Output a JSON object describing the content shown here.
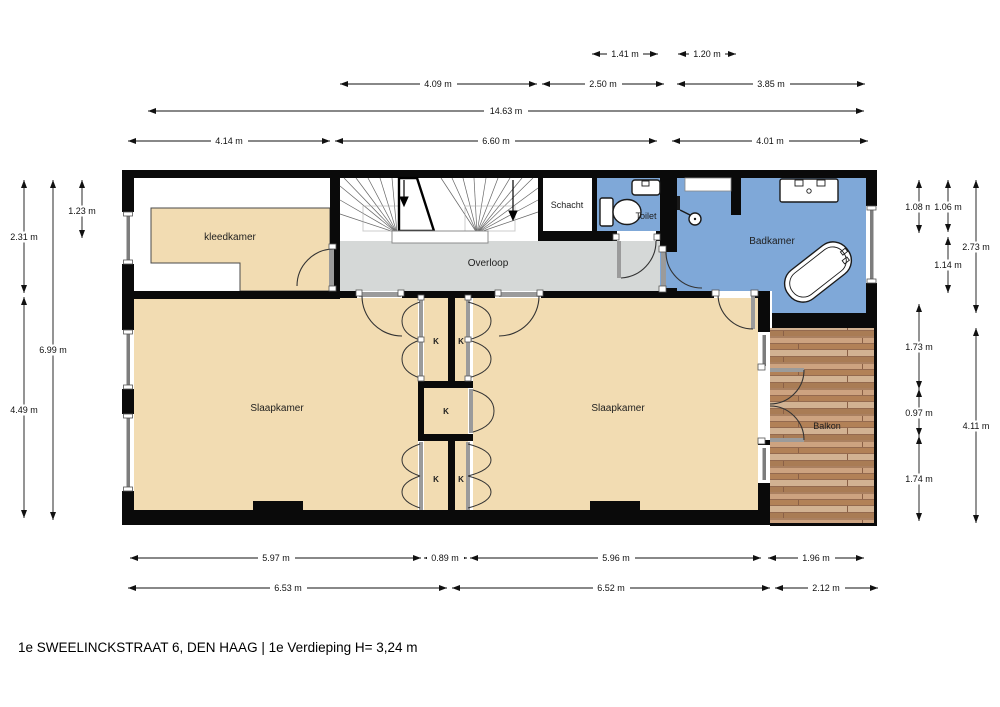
{
  "title": {
    "footer": "1e SWEELINCKSTRAAT 6, DEN HAAG | 1e Verdieping H= 3,24 m"
  },
  "rooms": {
    "kleedkamer": "kleedkamer",
    "schacht": "Schacht",
    "toilet": "Toilet",
    "overloop": "Overloop",
    "badkamer": "Badkamer",
    "slaapkamer_left": "Slaapkamer",
    "slaapkamer_right": "Slaapkamer",
    "balkon": "Balkon",
    "kast": "K"
  },
  "dimensions": {
    "top": [
      "1.41 m",
      "1.20 m",
      "4.09 m",
      "2.50 m",
      "3.85 m",
      "14.63 m",
      "4.14 m",
      "6.60 m",
      "4.01 m"
    ],
    "left": [
      "1.23 m",
      "2.31 m",
      "6.99 m",
      "4.49 m"
    ],
    "right": [
      "1.08 m",
      "1.06 m",
      "2.73 m",
      "1.14 m",
      "1.73 m",
      "0.97 m",
      "1.74 m",
      "4.11 m"
    ],
    "bottom": [
      "5.97 m",
      "0.89 m",
      "5.96 m",
      "1.96 m",
      "6.53 m",
      "6.52 m",
      "2.12 m"
    ]
  },
  "colors": {
    "floor_tan": "#f2dcb2",
    "wet_room_blue": "#7fa8d8",
    "landing_gray": "#d5d8d7",
    "wall_black": "#0a0a0a",
    "balcony_wood": "#bf9572"
  }
}
